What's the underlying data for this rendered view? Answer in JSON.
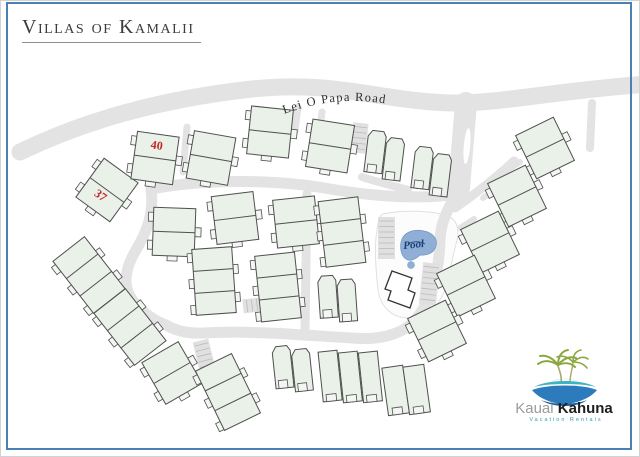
{
  "title": "Villas of Kamalii",
  "map": {
    "road_label": "Lei O Papa Road",
    "pool_label": "Pool",
    "roads": [
      {
        "name": "lei-o-papa-road",
        "d": "M 20,152 C 90,118 170,98 252,89 C 330,81 368,97 432,102 C 488,107 540,92 648,84",
        "w": 17
      },
      {
        "name": "entrance-road",
        "d": "M 466,103 L 459,188",
        "w": 22
      },
      {
        "name": "pool-loop-road",
        "d": "M 459,188 C 450,206 441,219 440,240 C 439,272 432,300 416,319 C 401,337 374,340 352,338",
        "w": 11
      },
      {
        "name": "bottom-road",
        "d": "M 352,338 C 312,336 255,330 205,333 C 188,334 176,331 166,325",
        "w": 11
      },
      {
        "name": "west-road",
        "d": "M 151,189 C 154,212 148,230 136,250 C 124,270 122,289 135,303 C 147,317 158,322 166,325",
        "w": 11
      },
      {
        "name": "central-road",
        "d": "M 151,189 C 210,178 280,180 330,189 C 370,196 420,200 459,194",
        "w": 11
      },
      {
        "name": "connector-road",
        "d": "M 307,194 L 305,330",
        "w": 9
      },
      {
        "name": "ne-diagonal-road",
        "d": "M 455,208 C 478,192 498,176 514,161",
        "w": 9
      },
      {
        "name": "driveway",
        "d": "M 505,172 L 520,162",
        "w": 6
      },
      {
        "name": "driveway",
        "d": "M 483,198 L 498,188",
        "w": 6
      },
      {
        "name": "driveway",
        "d": "M 460,228 L 474,219",
        "w": 6
      },
      {
        "name": "driveway",
        "d": "M 187,127 L 183,172",
        "w": 7
      },
      {
        "name": "driveway",
        "d": "M 298,107 L 295,131",
        "w": 7
      },
      {
        "name": "driveway",
        "d": "M 322,112 L 317,158",
        "w": 7
      },
      {
        "name": "driveway",
        "d": "M 592,103 L 590,148",
        "w": 8
      },
      {
        "name": "driveway",
        "d": "M 362,177 C 380,183 395,186 408,190",
        "w": 8
      },
      {
        "name": "driveway",
        "d": "M 417,317 C 424,326 428,336 430,347",
        "w": 8
      }
    ],
    "median": {
      "cx": 467,
      "cy": 146,
      "rx": 3.2,
      "ry": 18,
      "rot": 5
    },
    "parking_combs": [
      {
        "x": 378,
        "y": 217,
        "w": 17,
        "h": 42,
        "rot": 0,
        "horiz": false
      },
      {
        "x": 421,
        "y": 263,
        "w": 17,
        "h": 42,
        "rot": 6,
        "horiz": false
      },
      {
        "x": 197,
        "y": 340,
        "w": 16,
        "h": 38,
        "rot": -14,
        "horiz": false
      },
      {
        "x": 243,
        "y": 298,
        "w": 26,
        "h": 14,
        "rot": -6,
        "horiz": true
      },
      {
        "x": 352,
        "y": 123,
        "w": 15,
        "h": 30,
        "rot": 6,
        "horiz": false
      }
    ],
    "pool": {
      "deck_path": "M 383,214 C 400,210 430,210 448,216 C 458,220 460,232 456,244 C 452,258 450,276 444,292 C 438,308 424,318 408,318 C 392,318 380,306 378,290 C 376,272 374,246 377,230 C 378,222 379,216 383,214 Z",
      "water_path": "M 403,237 C 407,231 416,229 424,231 C 433,233 438,239 436,246 C 434,253 427,256 420,255 C 416,259 410,262 406,259 C 400,255 399,244 403,237 Z",
      "squiggle_path": "M 408,244 C 413,241 420,241 425,244",
      "blob": {
        "cx": 411,
        "cy": 265,
        "r": 3.5
      },
      "label_x": 414,
      "label_y": 248,
      "label_rot": -6
    },
    "clubhouse_path": "M 392,271 L 412,278 L 408,290 L 415,293 L 410,308 L 388,300 L 391,291 L 385,289 Z",
    "buildings": [
      {
        "x": 107,
        "y": 190,
        "rot": 36,
        "type": "duplex",
        "label": "37",
        "ldx": -2,
        "ldy": 12
      },
      {
        "x": 155,
        "y": 158,
        "rot": 8,
        "type": "duplex",
        "label": "40",
        "ldx": 0,
        "ldy": -9
      },
      {
        "x": 211,
        "y": 158,
        "rot": 10,
        "type": "duplex"
      },
      {
        "x": 270,
        "y": 132,
        "rot": 6,
        "type": "duplex"
      },
      {
        "x": 330,
        "y": 146,
        "rot": 9,
        "type": "duplex"
      },
      {
        "x": 385,
        "y": 155,
        "rot": 7,
        "type": "pair"
      },
      {
        "x": 432,
        "y": 171,
        "rot": 7,
        "type": "pair"
      },
      {
        "x": 545,
        "y": 148,
        "rot": -26,
        "type": "duplex"
      },
      {
        "x": 517,
        "y": 196,
        "rot": -26,
        "type": "duplex"
      },
      {
        "x": 490,
        "y": 242,
        "rot": -26,
        "type": "duplex"
      },
      {
        "x": 466,
        "y": 286,
        "rot": -26,
        "type": "duplex"
      },
      {
        "x": 437,
        "y": 331,
        "rot": -26,
        "type": "duplex"
      },
      {
        "x": 174,
        "y": 232,
        "rot": 2,
        "type": "duplex"
      },
      {
        "x": 235,
        "y": 218,
        "rot": -7,
        "type": "duplex"
      },
      {
        "x": 296,
        "y": 222,
        "rot": -6,
        "type": "duplex"
      },
      {
        "x": 342,
        "y": 232,
        "rot": -7,
        "type": "triplex"
      },
      {
        "x": 214,
        "y": 281,
        "rot": -4,
        "type": "triplex"
      },
      {
        "x": 278,
        "y": 287,
        "rot": -6,
        "type": "triplex"
      },
      {
        "x": 338,
        "y": 298,
        "rot": -4,
        "type": "pair"
      },
      {
        "x": 89,
        "y": 275,
        "rot": -38,
        "type": "triplex"
      },
      {
        "x": 130,
        "y": 327,
        "rot": -38,
        "type": "triplex"
      },
      {
        "x": 172,
        "y": 373,
        "rot": -30,
        "type": "duplex"
      },
      {
        "x": 228,
        "y": 392,
        "rot": -26,
        "type": "triplex"
      },
      {
        "x": 293,
        "y": 368,
        "rot": -6,
        "type": "pair"
      },
      {
        "x": 350,
        "y": 374,
        "rot": -6,
        "type": "row3"
      },
      {
        "x": 406,
        "y": 389,
        "rot": -8,
        "type": "row2"
      }
    ]
  },
  "logo": {
    "brand_gray": "Kauai ",
    "brand_dark": "Kahuna",
    "tagline": "Vacation Rentals"
  },
  "colors": {
    "frame_blue": "#4a80b5",
    "road_gray": "#e3e3e3",
    "comb_base": "#e0e0e0",
    "comb_line": "#bbbbbb",
    "building_fill": "#e9f1e8",
    "building_stub_fill": "#f3f6f3",
    "building_stroke": "#4f4f4f",
    "deck_fill": "#fcfcfc",
    "deck_stroke": "#e0e0e0",
    "pool_fill": "#8fafd6",
    "pool_stroke": "#6f93c4",
    "pool_detail": "#33527e",
    "pool_text": "#1c3f77",
    "clubhouse_stroke": "#333333",
    "unit_label_red": "#c22a27",
    "road_text": "#2f2f2f",
    "logo_teal": "#3cb4c4",
    "logo_blue": "#2b7bbd",
    "logo_dark_blue": "#1a5a97",
    "palm_green": "#8aa83f",
    "palm_trunk": "#a8a868"
  }
}
